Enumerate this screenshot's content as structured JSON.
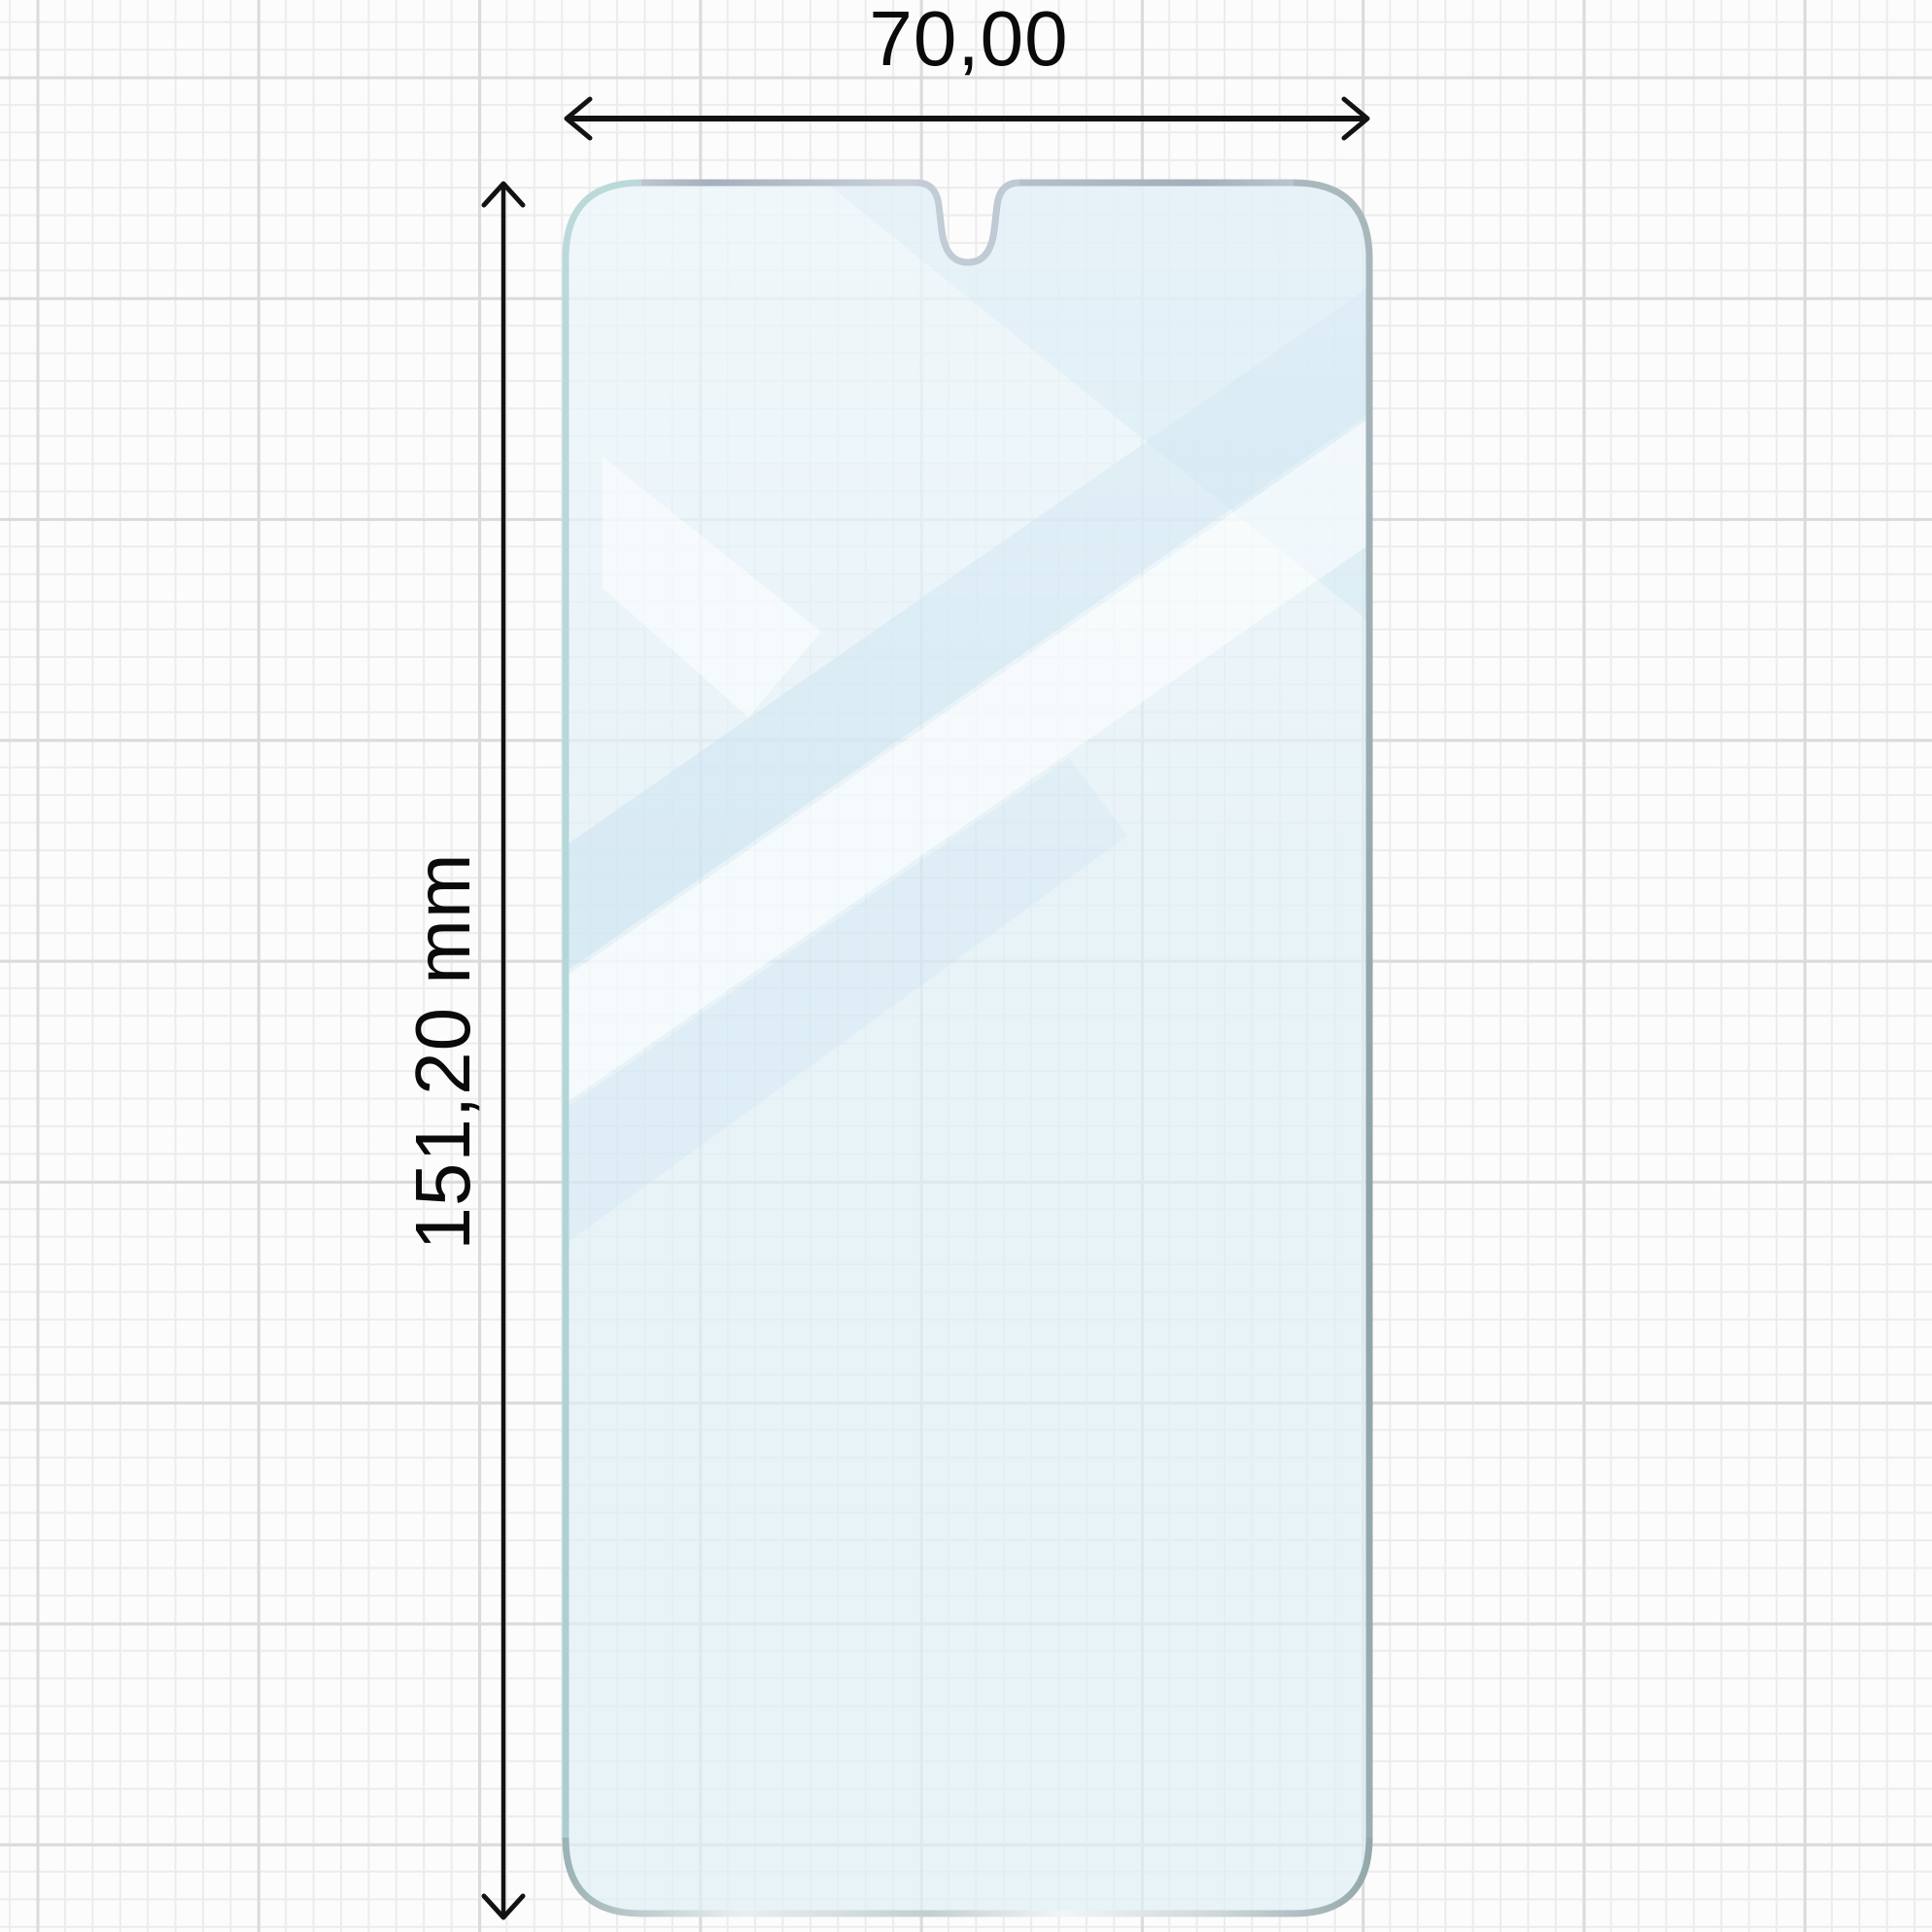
{
  "diagram": {
    "type": "screen-protector-dimension-drawing",
    "horizontal_dimension": {
      "label": "70,00"
    },
    "vertical_dimension": {
      "label": "151,20 mm"
    },
    "colors": {
      "paper": "#fcfcfc",
      "grid_minor": "#ececec",
      "grid_major": "#dbdbdb",
      "dimension_line": "#121212",
      "label_text": "#0a0a0a",
      "glass_fill": "#deeff6",
      "edge_silver_light": "#ccd3db",
      "edge_silver_dark": "#9faebb",
      "edge_teal": "#b2d7d9",
      "edge_gray": "#8ea3a6",
      "shine_bright": "#f1f5f6",
      "reflection_blue": "#c5e0ef",
      "reflection_white": "#ffffff"
    }
  }
}
